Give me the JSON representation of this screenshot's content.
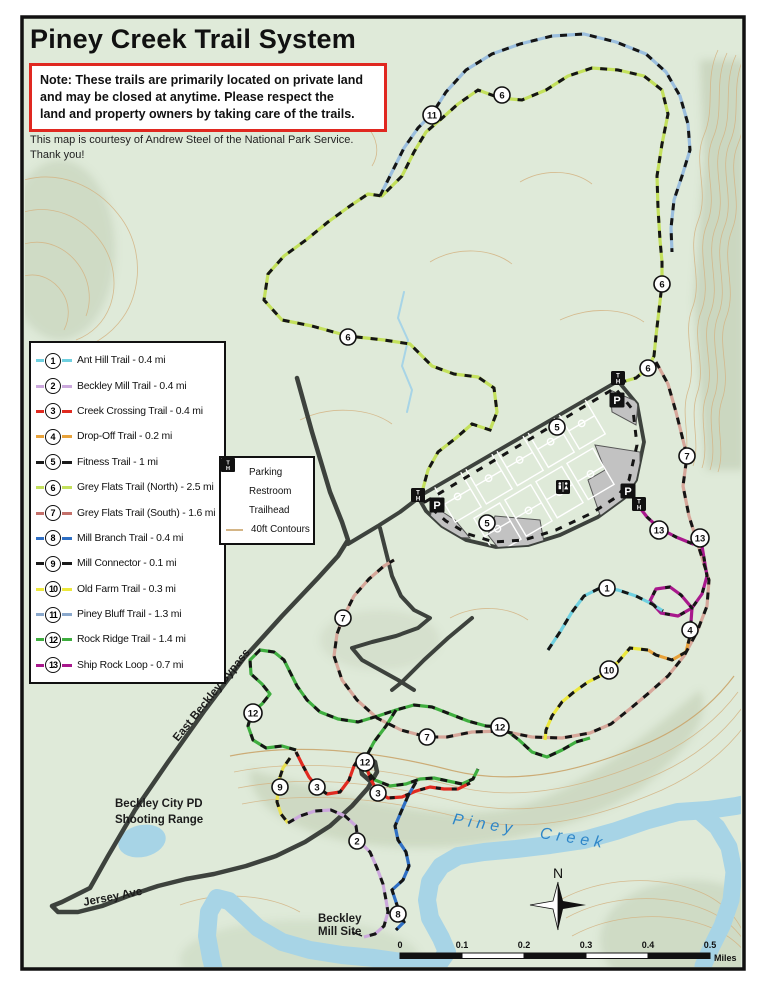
{
  "header": {
    "title": "Piney Creek Trail System",
    "note_lines": [
      "Note: These trails are primarily located on private land",
      "and may be closed at anytime. Please respect the",
      "land and property owners by taking care of the trails."
    ],
    "courtesy_lines": [
      "This map is courtesy of Andrew Steel of the National Park Service.",
      "Thank you!"
    ]
  },
  "trails": [
    {
      "num": "1",
      "name": "Ant Hill Trail",
      "length": "0.4 mi",
      "color": "#6fd0e0",
      "legend_color": "#6fd0e0"
    },
    {
      "num": "2",
      "name": "Beckley Mill Trail",
      "length": "0.4 mi",
      "color": "#cba8dc",
      "legend_color": "#cba8dc"
    },
    {
      "num": "3",
      "name": "Creek Crossing Trail",
      "length": "0.4 mi",
      "color": "#e02a20",
      "legend_color": "#e02a20"
    },
    {
      "num": "4",
      "name": "Drop-Off Trail",
      "length": "0.2 mi",
      "color": "#e8a23a",
      "legend_color": "#e8a23a"
    },
    {
      "num": "5",
      "name": "Fitness Trail",
      "length": "1 mi",
      "color": "#1a1a1a",
      "legend_color": "#1a1a1a"
    },
    {
      "num": "6",
      "name": "Grey Flats Trail (North)",
      "length": "2.5 mi",
      "color": "#c3e05c",
      "legend_color": "#c3e05c"
    },
    {
      "num": "7",
      "name": "Grey Flats Trail (South)",
      "length": "1.6 mi",
      "color": "#d6a79a",
      "legend_color": "#c4706a"
    },
    {
      "num": "8",
      "name": "Mill Branch Trail",
      "length": "0.4 mi",
      "color": "#2f6fc4",
      "legend_color": "#2f6fc4"
    },
    {
      "num": "9",
      "name": "Mill Connector",
      "length": "0.1 mi",
      "color": "#e8e050",
      "legend_color": "#1a1a1a"
    },
    {
      "num": "10",
      "name": "Old Farm Trail",
      "length": "0.3 mi",
      "color": "#ece83c",
      "legend_color": "#ece83c"
    },
    {
      "num": "11",
      "name": "Piney Bluff Trail",
      "length": "1.3 mi",
      "color": "#9abede",
      "legend_color": "#8aa8cc"
    },
    {
      "num": "12",
      "name": "Rock Ridge Trail",
      "length": "1.4 mi",
      "color": "#3fae3f",
      "legend_color": "#3fae3f"
    },
    {
      "num": "13",
      "name": "Ship Rock Loop",
      "length": "0.7 mi",
      "color": "#a8188c",
      "legend_color": "#a8188c"
    }
  ],
  "map_key": {
    "parking": "Parking",
    "restroom": "Restroom",
    "trailhead": "Trailhead",
    "contours": "40ft Contours"
  },
  "icons": {
    "parking": "P",
    "trailhead_t": "T",
    "trailhead_h": "H"
  },
  "map_labels": {
    "bypass": "East Beckley Bypass",
    "shooting_line1": "Beckley City PD",
    "shooting_line2": "Shooting  Range",
    "jersey": "Jersey Ave",
    "creek": "Piney Creek",
    "mill_line1": "Beckley",
    "mill_line2": "Mill Site",
    "north": "N"
  },
  "scale": {
    "ticks": [
      "0",
      "0.1",
      "0.2",
      "0.3",
      "0.4",
      "0.5"
    ],
    "unit": "Miles"
  },
  "markers": [
    {
      "n": "6",
      "x": 502,
      "y": 95
    },
    {
      "n": "11",
      "x": 432,
      "y": 115
    },
    {
      "n": "6",
      "x": 662,
      "y": 284
    },
    {
      "n": "6",
      "x": 348,
      "y": 337
    },
    {
      "n": "6",
      "x": 648,
      "y": 368
    },
    {
      "n": "5",
      "x": 557,
      "y": 427
    },
    {
      "n": "7",
      "x": 687,
      "y": 456
    },
    {
      "n": "5",
      "x": 487,
      "y": 523
    },
    {
      "n": "13",
      "x": 659,
      "y": 530
    },
    {
      "n": "13",
      "x": 700,
      "y": 538
    },
    {
      "n": "1",
      "x": 607,
      "y": 588
    },
    {
      "n": "7",
      "x": 343,
      "y": 618
    },
    {
      "n": "4",
      "x": 690,
      "y": 630
    },
    {
      "n": "10",
      "x": 609,
      "y": 670
    },
    {
      "n": "12",
      "x": 253,
      "y": 713
    },
    {
      "n": "12",
      "x": 500,
      "y": 727
    },
    {
      "n": "7",
      "x": 427,
      "y": 737
    },
    {
      "n": "12",
      "x": 365,
      "y": 762
    },
    {
      "n": "3",
      "x": 317,
      "y": 787
    },
    {
      "n": "9",
      "x": 280,
      "y": 787
    },
    {
      "n": "3",
      "x": 378,
      "y": 793
    },
    {
      "n": "2",
      "x": 357,
      "y": 841
    },
    {
      "n": "8",
      "x": 398,
      "y": 914
    }
  ],
  "colors": {
    "map_bg": "#dfead9",
    "contour": "#d4b586",
    "water": "#a7d4e6",
    "road": "#3d423d",
    "note_border": "#e02820",
    "creek_label": "#2e86c8"
  }
}
